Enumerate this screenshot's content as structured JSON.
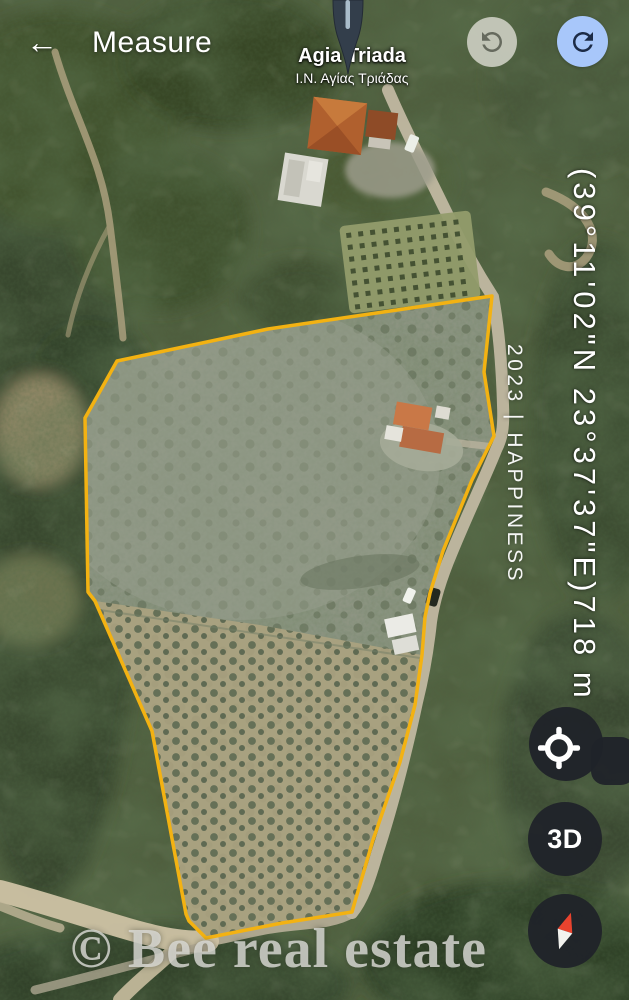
{
  "topbar": {
    "back_icon": "←",
    "title": "Measure"
  },
  "map": {
    "poi": {
      "title": "Agia Triada",
      "subtitle": "Ι.Ν. Αγίας Τριάδας"
    },
    "overlays": {
      "coordinates": "(39°11'02\"N 23°37'37\"E)718 m",
      "listing_tag": "2023 | HAPPINESS",
      "watermark": "© Bee real estate"
    }
  },
  "measure": {
    "polygon_points": "492,296 484,372 494,436 472,480 443,551 430,593 425,617 422,655 415,705 400,762 373,840 356,898 352,912 282,923 206,938 189,921 186,914 152,731 95,601 88,592 85,418 117,361 268,329",
    "outline_color": "#f3b212"
  },
  "controls": {
    "undo": "undo",
    "redo": "redo",
    "locate": "my-location",
    "three_d_label": "3D",
    "compass": "compass"
  },
  "colors": {
    "undo_bg": "#d0d1c6",
    "redo_bg": "#a8c7fa",
    "fab_bg": "#202329",
    "compass_north": "#e8432e"
  }
}
